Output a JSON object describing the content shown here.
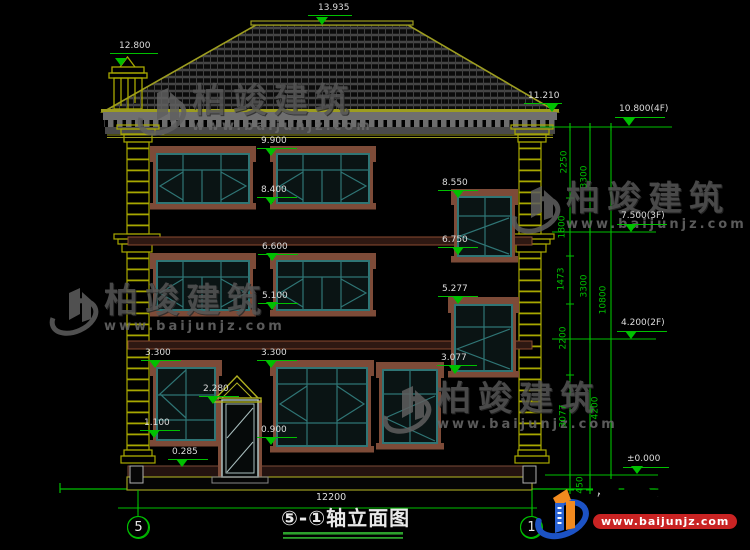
{
  "colors": {
    "green": "#00c000",
    "olive": "#a8a800",
    "teal": "#2f7575",
    "brown": "#7d4b38",
    "text": "#dddddd",
    "watermark_gray": "#5a5a5a",
    "logo_blue": "#1c52c4",
    "logo_orange": "#f28a1e",
    "logo_red": "#c92323"
  },
  "title_block": {
    "title": "⑤-①轴立面图",
    "overall_dimension": "12200",
    "left_axis": "5",
    "right_axis": "1"
  },
  "watermark": {
    "name": "柏竣建筑",
    "url": "www.baijunjz.com",
    "instances": [
      {
        "x": 136,
        "y": 84
      },
      {
        "x": 510,
        "y": 182
      },
      {
        "x": 48,
        "y": 284
      },
      {
        "x": 381,
        "y": 382
      }
    ]
  },
  "brand": {
    "name": "柏竣建筑",
    "url": "www.baijunjz.com"
  },
  "elevation_marks": [
    {
      "label": "13.935",
      "x": 318,
      "y": 4,
      "lx": 308,
      "ly": 15,
      "lw": 44,
      "ax": 322,
      "ay": 25
    },
    {
      "label": "12.800",
      "x": 119,
      "y": 42,
      "lx": 110,
      "ly": 53,
      "lw": 48,
      "ax": 121,
      "ay": 66
    },
    {
      "label": "11.210",
      "x": 528,
      "y": 92,
      "lx": 524,
      "ly": 103,
      "lw": 38,
      "ax": 552,
      "ay": 112
    },
    {
      "label": "9.900",
      "x": 261,
      "y": 137,
      "lx": 257,
      "ly": 148,
      "lw": 40,
      "ax": 271,
      "ay": 156
    },
    {
      "label": "8.400",
      "x": 261,
      "y": 186,
      "lx": 257,
      "ly": 197,
      "lw": 40,
      "ax": 271,
      "ay": 205
    },
    {
      "label": "8.550",
      "x": 442,
      "y": 179,
      "lx": 438,
      "ly": 190,
      "lw": 40,
      "ax": 458,
      "ay": 198
    },
    {
      "label": "6.600",
      "x": 262,
      "y": 243,
      "lx": 258,
      "ly": 254,
      "lw": 40,
      "ax": 272,
      "ay": 261
    },
    {
      "label": "6.750",
      "x": 442,
      "y": 236,
      "lx": 438,
      "ly": 247,
      "lw": 40,
      "ax": 458,
      "ay": 255
    },
    {
      "label": "5.100",
      "x": 262,
      "y": 292,
      "lx": 258,
      "ly": 303,
      "lw": 40,
      "ax": 272,
      "ay": 310
    },
    {
      "label": "5.277",
      "x": 442,
      "y": 285,
      "lx": 438,
      "ly": 296,
      "lw": 40,
      "ax": 458,
      "ay": 304
    },
    {
      "label": "3.300",
      "x": 145,
      "y": 349,
      "lx": 141,
      "ly": 360,
      "lw": 40,
      "ax": 155,
      "ay": 368
    },
    {
      "label": "3.300",
      "x": 261,
      "y": 349,
      "lx": 257,
      "ly": 360,
      "lw": 40,
      "ax": 271,
      "ay": 368
    },
    {
      "label": "3.077",
      "x": 441,
      "y": 354,
      "lx": 437,
      "ly": 365,
      "lw": 40,
      "ax": 455,
      "ay": 374
    },
    {
      "label": "2.280",
      "x": 203,
      "y": 385,
      "lx": 199,
      "ly": 396,
      "lw": 40,
      "ax": 213,
      "ay": 404
    },
    {
      "label": "1.100",
      "x": 144,
      "y": 419,
      "lx": 140,
      "ly": 430,
      "lw": 40,
      "ax": 154,
      "ay": 438
    },
    {
      "label": "0.900",
      "x": 261,
      "y": 426,
      "lx": 257,
      "ly": 437,
      "lw": 40,
      "ax": 271,
      "ay": 445
    },
    {
      "label": "0.285",
      "x": 172,
      "y": 448,
      "lx": 168,
      "ly": 459,
      "lw": 40,
      "ax": 182,
      "ay": 467
    },
    {
      "label": "10.800(4F)",
      "x": 619,
      "y": 105,
      "lx": 615,
      "ly": 117,
      "lw": 50,
      "ax": 629,
      "ay": 126
    },
    {
      "label": "7.500(3F)",
      "x": 621,
      "y": 212,
      "lx": 617,
      "ly": 224,
      "lw": 50,
      "ax": 631,
      "ay": 232
    },
    {
      "label": "4.200(2F)",
      "x": 621,
      "y": 319,
      "lx": 617,
      "ly": 331,
      "lw": 50,
      "ax": 631,
      "ay": 339
    },
    {
      "label": "±0.000",
      "x": 627,
      "y": 455,
      "lx": 623,
      "ly": 467,
      "lw": 46,
      "ax": 637,
      "ay": 474
    }
  ],
  "dimension_texts": [
    {
      "label": "2250",
      "cx": 565,
      "cy": 162
    },
    {
      "label": "3300",
      "cx": 585,
      "cy": 177
    },
    {
      "label": "1800",
      "cx": 563,
      "cy": 227
    },
    {
      "label": "1473",
      "cx": 562,
      "cy": 279
    },
    {
      "label": "3300",
      "cx": 585,
      "cy": 286
    },
    {
      "label": "10800",
      "cx": 604,
      "cy": 300
    },
    {
      "label": "2200",
      "cx": 564,
      "cy": 338
    },
    {
      "label": "4200",
      "cx": 596,
      "cy": 408
    },
    {
      "label": "3077",
      "cx": 564,
      "cy": 416
    },
    {
      "label": "450",
      "cx": 581,
      "cy": 485
    }
  ]
}
